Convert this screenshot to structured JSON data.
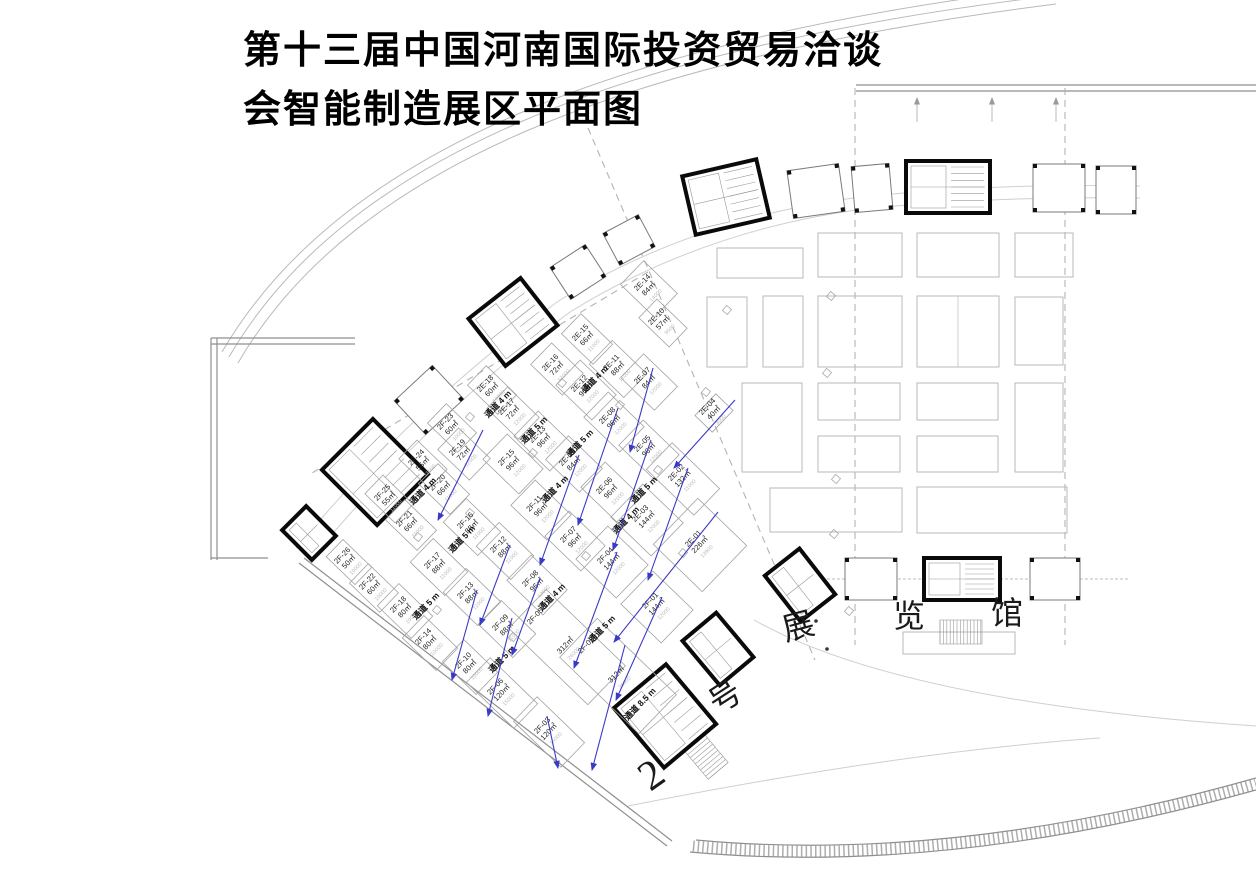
{
  "title": {
    "line1": "第十三届中国河南国际投资贸易洽谈",
    "line2": "会智能制造展区平面图"
  },
  "hall_label": {
    "text": "2号展览馆",
    "chars": [
      {
        "ch": "2",
        "x": 659,
        "y": 786,
        "rot": -35,
        "size": 42
      },
      {
        "ch": "号",
        "x": 731,
        "y": 706,
        "rot": -33,
        "size": 32
      },
      {
        "ch": "展",
        "x": 801,
        "y": 637,
        "rot": -15,
        "size": 32
      },
      {
        "ch": "览",
        "x": 909,
        "y": 627,
        "rot": 0,
        "size": 32
      },
      {
        "ch": "馆",
        "x": 1007,
        "y": 624,
        "rot": 0,
        "size": 32
      }
    ]
  },
  "plan": {
    "angle": -46
  },
  "colors": {
    "arrow": "#3a3ac8",
    "wall": "#0a0a0a",
    "line": "#a3a3a3",
    "dim": "#bdbdbd"
  },
  "booths": [
    {
      "id": "2E-14",
      "area": "84㎡",
      "dim": "14000",
      "x": 649,
      "y": 289,
      "w": 33,
      "h": 47
    },
    {
      "id": "2E-10",
      "area": "57㎡",
      "dim": "9500",
      "x": 663,
      "y": 323,
      "w": 26,
      "h": 42
    },
    {
      "id": "2E-15",
      "area": "66㎡",
      "dim": "11000",
      "x": 587,
      "y": 339,
      "w": 28,
      "h": 44
    },
    {
      "id": "2E-11",
      "area": "88㎡",
      "dim": "11000",
      "x": 618,
      "y": 369,
      "w": 33,
      "h": 48
    },
    {
      "id": "2E-16",
      "area": "72㎡",
      "dim": "12000",
      "x": 557,
      "y": 369,
      "w": 30,
      "h": 44
    },
    {
      "id": "2E-12",
      "area": "96㎡",
      "dim": "12000",
      "x": 586,
      "y": 390,
      "w": 35,
      "h": 50
    },
    {
      "id": "2E-18",
      "area": "60㎡",
      "dim": "10000",
      "x": 492,
      "y": 390,
      "w": 27,
      "h": 42
    },
    {
      "id": "2E-17",
      "area": "72㎡",
      "dim": "12000",
      "x": 513,
      "y": 413,
      "w": 30,
      "h": 44
    },
    {
      "id": "2E-13",
      "area": "96㎡",
      "dim": "12000",
      "x": 544,
      "y": 441,
      "w": 35,
      "h": 50
    },
    {
      "id": "2E-07",
      "area": "84㎡",
      "dim": "12000",
      "x": 649,
      "y": 382,
      "w": 33,
      "h": 47
    },
    {
      "id": "2E-08",
      "area": "96㎡",
      "dim": "12000",
      "x": 614,
      "y": 422,
      "w": 35,
      "h": 50
    },
    {
      "id": "2E-04",
      "area": "40㎡",
      "dim": "8000",
      "x": 714,
      "y": 413,
      "w": 30,
      "h": 24
    },
    {
      "id": "2E-05",
      "area": "96㎡",
      "dim": "12000",
      "x": 649,
      "y": 450,
      "w": 35,
      "h": 50
    },
    {
      "id": "2E-09",
      "area": "84㎡",
      "dim": "12000",
      "x": 574,
      "y": 464,
      "w": 33,
      "h": 47
    },
    {
      "id": "2E-06",
      "area": "96㎡",
      "dim": "12000",
      "x": 611,
      "y": 492,
      "w": 35,
      "h": 50
    },
    {
      "id": "2E-02",
      "area": "132㎡",
      "dim": "11000",
      "x": 683,
      "y": 479,
      "w": 37,
      "h": 66
    },
    {
      "id": "2E-03",
      "area": "144㎡",
      "dim": "12000",
      "x": 647,
      "y": 520,
      "w": 46,
      "h": 56
    },
    {
      "id": "2E-01",
      "area": "226㎡",
      "dim": "13900",
      "x": 700,
      "y": 545,
      "w": 64,
      "h": 68
    },
    {
      "id": "2F-23",
      "area": "60㎡",
      "dim": "10000",
      "x": 452,
      "y": 428,
      "w": 27,
      "h": 42
    },
    {
      "id": "2F-19",
      "area": "72㎡",
      "dim": "12000",
      "x": 464,
      "y": 454,
      "w": 30,
      "h": 44
    },
    {
      "id": "2F-24",
      "area": "55㎡",
      "dim": "11000",
      "x": 423,
      "y": 464,
      "w": 26,
      "h": 42
    },
    {
      "id": "2F-20",
      "area": "66㎡",
      "dim": "11000",
      "x": 444,
      "y": 489,
      "w": 28,
      "h": 44
    },
    {
      "id": "2F-25",
      "area": "55㎡",
      "dim": "11000",
      "x": 389,
      "y": 499,
      "w": 26,
      "h": 42
    },
    {
      "id": "2F-21",
      "area": "66㎡",
      "dim": "11000",
      "x": 411,
      "y": 525,
      "w": 28,
      "h": 44
    },
    {
      "id": "2F-26",
      "area": "50㎡",
      "dim": "10000",
      "x": 349,
      "y": 562,
      "w": 24,
      "h": 40
    },
    {
      "id": "2F-22",
      "area": "60㎡",
      "dim": "10000",
      "x": 374,
      "y": 588,
      "w": 27,
      "h": 42
    },
    {
      "id": "2F-15",
      "area": "96㎡",
      "dim": "12000",
      "x": 513,
      "y": 464,
      "w": 35,
      "h": 50
    },
    {
      "id": "2F-11",
      "area": "96㎡",
      "dim": "12000",
      "x": 541,
      "y": 510,
      "w": 35,
      "h": 50
    },
    {
      "id": "2F-16",
      "area": "88㎡",
      "dim": "11000",
      "x": 472,
      "y": 527,
      "w": 33,
      "h": 48
    },
    {
      "id": "2F-12",
      "area": "88㎡",
      "dim": "11000",
      "x": 505,
      "y": 551,
      "w": 33,
      "h": 48
    },
    {
      "id": "2F-17",
      "area": "88㎡",
      "dim": "11000",
      "x": 439,
      "y": 567,
      "w": 33,
      "h": 48
    },
    {
      "id": "2F-13",
      "area": "88㎡",
      "dim": "11000",
      "x": 472,
      "y": 597,
      "w": 33,
      "h": 48
    },
    {
      "id": "2F-18",
      "area": "80㎡",
      "dim": "10000",
      "x": 405,
      "y": 611,
      "w": 31,
      "h": 47
    },
    {
      "id": "2F-14",
      "area": "80㎡",
      "dim": "10000",
      "x": 430,
      "y": 643,
      "w": 31,
      "h": 47
    },
    {
      "id": "2F-09",
      "area": "88㎡",
      "dim": "11000",
      "x": 507,
      "y": 629,
      "w": 33,
      "h": 48
    },
    {
      "id": "2F-10",
      "area": "80㎡",
      "dim": "10000",
      "x": 470,
      "y": 667,
      "w": 31,
      "h": 47
    },
    {
      "id": "2F-06",
      "area": "120㎡",
      "dim": "15000",
      "x": 502,
      "y": 693,
      "w": 34,
      "h": 66
    },
    {
      "id": "2F-07",
      "area": "96㎡",
      "dim": "12000",
      "x": 575,
      "y": 541,
      "w": 35,
      "h": 50
    },
    {
      "id": "2F-08",
      "area": "96㎡",
      "dim": "12000",
      "x": 537,
      "y": 585,
      "w": 35,
      "h": 50
    },
    {
      "id": "2F-04",
      "area": "144㎡",
      "dim": "12000",
      "x": 612,
      "y": 562,
      "w": 46,
      "h": 56
    },
    {
      "id": "2F-01",
      "area": "144㎡",
      "dim": "12000",
      "x": 657,
      "y": 607,
      "w": 46,
      "h": 56
    },
    {
      "id": "2F-05",
      "area": "312㎡",
      "dim": "26000",
      "x": 567,
      "y": 647,
      "w": 54,
      "h": 110
    },
    {
      "id": "2F-02",
      "area": "312㎡",
      "dim": "26000",
      "x": 618,
      "y": 676,
      "w": 54,
      "h": 110
    },
    {
      "id": "2F-03",
      "area": "120㎡",
      "dim": "15000",
      "x": 549,
      "y": 732,
      "w": 34,
      "h": 66
    }
  ],
  "aisles": [
    {
      "label": "通道 4 m",
      "x": 500,
      "y": 406
    },
    {
      "label": "通道 4 m",
      "x": 597,
      "y": 381
    },
    {
      "label": "通道 5 m",
      "x": 536,
      "y": 432
    },
    {
      "label": "通道 5 m",
      "x": 582,
      "y": 445
    },
    {
      "label": "通道 4 m",
      "x": 425,
      "y": 493
    },
    {
      "label": "通道 4 m",
      "x": 557,
      "y": 491
    },
    {
      "label": "通道 5 m",
      "x": 464,
      "y": 541
    },
    {
      "label": "通道 4 m",
      "x": 628,
      "y": 522
    },
    {
      "label": "通道 5 m",
      "x": 646,
      "y": 492
    },
    {
      "label": "通道 5 m",
      "x": 428,
      "y": 608
    },
    {
      "label": "通道 5 m",
      "x": 504,
      "y": 661
    },
    {
      "label": "通道 4 m",
      "x": 554,
      "y": 599
    },
    {
      "label": "通道 5 m",
      "x": 604,
      "y": 631
    },
    {
      "label": "通道 8.5 m",
      "x": 642,
      "y": 706
    }
  ],
  "arrows": [
    [
      483,
      430,
      438,
      520
    ],
    [
      618,
      408,
      578,
      525
    ],
    [
      651,
      440,
      613,
      550
    ],
    [
      579,
      455,
      540,
      565
    ],
    [
      688,
      468,
      648,
      580
    ],
    [
      718,
      512,
      614,
      642
    ],
    [
      735,
      400,
      674,
      468
    ],
    [
      653,
      368,
      630,
      452
    ],
    [
      510,
      545,
      480,
      625
    ],
    [
      512,
      618,
      488,
      716
    ],
    [
      477,
      590,
      452,
      680
    ],
    [
      540,
      578,
      512,
      655
    ],
    [
      617,
      552,
      574,
      668
    ],
    [
      662,
      597,
      616,
      700
    ],
    [
      625,
      645,
      592,
      770
    ],
    [
      547,
      716,
      558,
      768
    ]
  ],
  "open_areas": [
    [
      717,
      248,
      86,
      30
    ],
    [
      818,
      233,
      84,
      44
    ],
    [
      917,
      233,
      82,
      44
    ],
    [
      1015,
      233,
      58,
      44
    ],
    [
      707,
      297,
      40,
      70
    ],
    [
      763,
      296,
      40,
      71
    ],
    [
      818,
      296,
      84,
      71
    ],
    [
      917,
      296,
      82,
      71
    ],
    [
      1015,
      297,
      48,
      68
    ],
    [
      742,
      383,
      60,
      89
    ],
    [
      818,
      383,
      82,
      37
    ],
    [
      917,
      383,
      81,
      37
    ],
    [
      818,
      436,
      82,
      36
    ],
    [
      917,
      436,
      81,
      36
    ],
    [
      1015,
      383,
      48,
      89
    ],
    [
      770,
      488,
      132,
      44
    ],
    [
      917,
      487,
      150,
      46
    ]
  ],
  "markers": [
    [
      831,
      296
    ],
    [
      827,
      373
    ],
    [
      836,
      479
    ],
    [
      706,
      392
    ],
    [
      834,
      534
    ],
    [
      727,
      310
    ],
    [
      562,
      383
    ],
    [
      533,
      453
    ],
    [
      470,
      513
    ],
    [
      437,
      610
    ],
    [
      513,
      637
    ],
    [
      586,
      556
    ],
    [
      658,
      470
    ],
    [
      620,
      405
    ],
    [
      683,
      553
    ],
    [
      470,
      417
    ],
    [
      418,
      537
    ],
    [
      849,
      611
    ]
  ],
  "cores": [
    {
      "x": 309,
      "y": 533,
      "w": 34,
      "h": 42,
      "r": -45,
      "solid": true,
      "stair": false
    },
    {
      "x": 375,
      "y": 472,
      "w": 72,
      "h": 78,
      "r": -45,
      "solid": true,
      "stair": true
    },
    {
      "x": 429,
      "y": 400,
      "w": 52,
      "h": 46,
      "r": -43,
      "solid": false,
      "stair": false
    },
    {
      "x": 513,
      "y": 322,
      "w": 66,
      "h": 60,
      "r": -38,
      "solid": true,
      "stair": true
    },
    {
      "x": 578,
      "y": 272,
      "w": 42,
      "h": 38,
      "r": -33,
      "solid": false,
      "stair": false
    },
    {
      "x": 629,
      "y": 240,
      "w": 40,
      "h": 36,
      "r": -28,
      "solid": false,
      "stair": false
    },
    {
      "x": 726,
      "y": 197,
      "w": 76,
      "h": 60,
      "r": -13,
      "solid": true,
      "stair": true
    },
    {
      "x": 816,
      "y": 191,
      "w": 52,
      "h": 48,
      "r": -8,
      "solid": false,
      "stair": false
    },
    {
      "x": 872,
      "y": 188,
      "w": 38,
      "h": 46,
      "r": -5,
      "solid": false,
      "stair": false
    },
    {
      "x": 948,
      "y": 187,
      "w": 84,
      "h": 52,
      "r": 0,
      "solid": true,
      "stair": true
    },
    {
      "x": 1059,
      "y": 188,
      "w": 52,
      "h": 48,
      "r": 0,
      "solid": false,
      "stair": false
    },
    {
      "x": 1116,
      "y": 190,
      "w": 40,
      "h": 48,
      "r": 0,
      "solid": false,
      "stair": false
    },
    {
      "x": 800,
      "y": 585,
      "w": 44,
      "h": 58,
      "r": -38,
      "solid": true,
      "stair": false
    },
    {
      "x": 718,
      "y": 649,
      "w": 44,
      "h": 58,
      "r": -40,
      "solid": true,
      "stair": false
    },
    {
      "x": 665,
      "y": 716,
      "w": 68,
      "h": 78,
      "r": -40,
      "solid": true,
      "stair": true
    },
    {
      "x": 871,
      "y": 579,
      "w": 52,
      "h": 42,
      "r": 0,
      "solid": false,
      "stair": false
    },
    {
      "x": 962,
      "y": 579,
      "w": 76,
      "h": 42,
      "r": 0,
      "solid": true,
      "stair": true
    },
    {
      "x": 1055,
      "y": 579,
      "w": 50,
      "h": 42,
      "r": 0,
      "solid": false,
      "stair": false
    }
  ],
  "gridlines": {
    "vertical": [
      [
        855,
        88,
        855,
        645
      ],
      [
        1065,
        88,
        1065,
        645
      ]
    ],
    "diagonal": [
      [
        588,
        128,
        815,
        660
      ],
      [
        648,
        272,
        312,
        473
      ]
    ]
  }
}
